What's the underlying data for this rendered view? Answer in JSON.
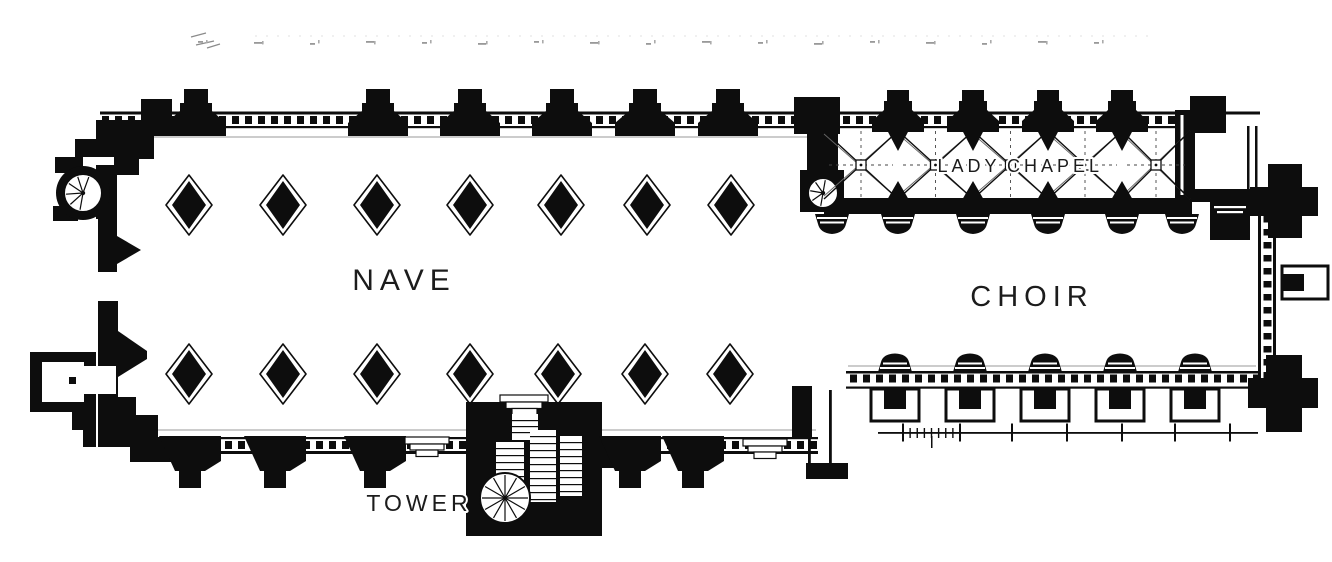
{
  "document": {
    "description": "Scanned black-and-white architectural floor plan of a church with nave, choir, lady chapel and tower"
  },
  "labels": {
    "nave": "NAVE",
    "choir": "CHOIR",
    "lady_chapel": {
      "word1": "LADY",
      "word2": "CHAPEL"
    },
    "tower": "TOWER"
  },
  "colors": {
    "ink": "#0d0d0d",
    "paper": "#ffffff",
    "faint_marks": "#9a9a9a"
  },
  "scale_bar": {
    "unlabeled": true,
    "major_ticks": 7,
    "minor_subdivisions": 8
  },
  "margin_artifacts": {
    "description": "faint illegible print-through marks along the top edge",
    "count": 17
  }
}
